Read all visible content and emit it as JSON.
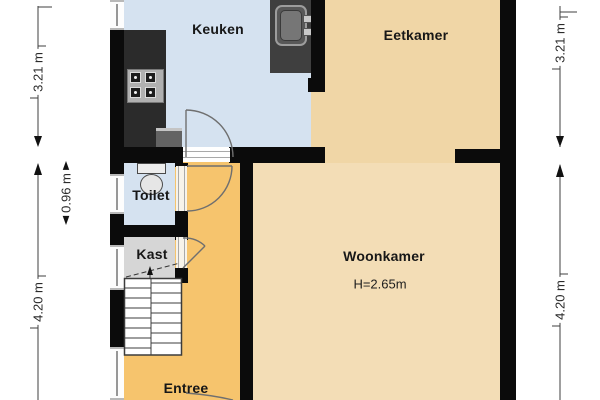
{
  "floorplan": {
    "rooms": {
      "keuken": {
        "label": "Keuken"
      },
      "eetkamer": {
        "label": "Eetkamer"
      },
      "toilet": {
        "label": "Toilet"
      },
      "kast": {
        "label": "Kast"
      },
      "woonkamer": {
        "label": "Woonkamer",
        "height_note": "H=2.65m"
      },
      "entree": {
        "label": "Entree"
      }
    },
    "dimensions": {
      "left_top": "3.21 m",
      "left_toilet": "0.96 m",
      "left_bottom": "4.20 m",
      "right_top": "3.21 m",
      "right_bottom": "4.20 m"
    },
    "fixtures": [
      "kitchen-counter",
      "stove",
      "kitchen-sink",
      "toilet-bowl",
      "staircase",
      "doors",
      "windows"
    ],
    "colors": {
      "wall": "#0b0b0b",
      "kitchen_floor": "#d5e2f0",
      "dining_floor": "#f0d6a6",
      "living_floor": "#f3ddb6",
      "hall_floor": "#f6c46d",
      "closet_floor": "#d6d6d6",
      "counter": "#2b2b2b",
      "sink_counter": "#3f3f3f",
      "dimension_text": "#2b2b2b"
    }
  }
}
